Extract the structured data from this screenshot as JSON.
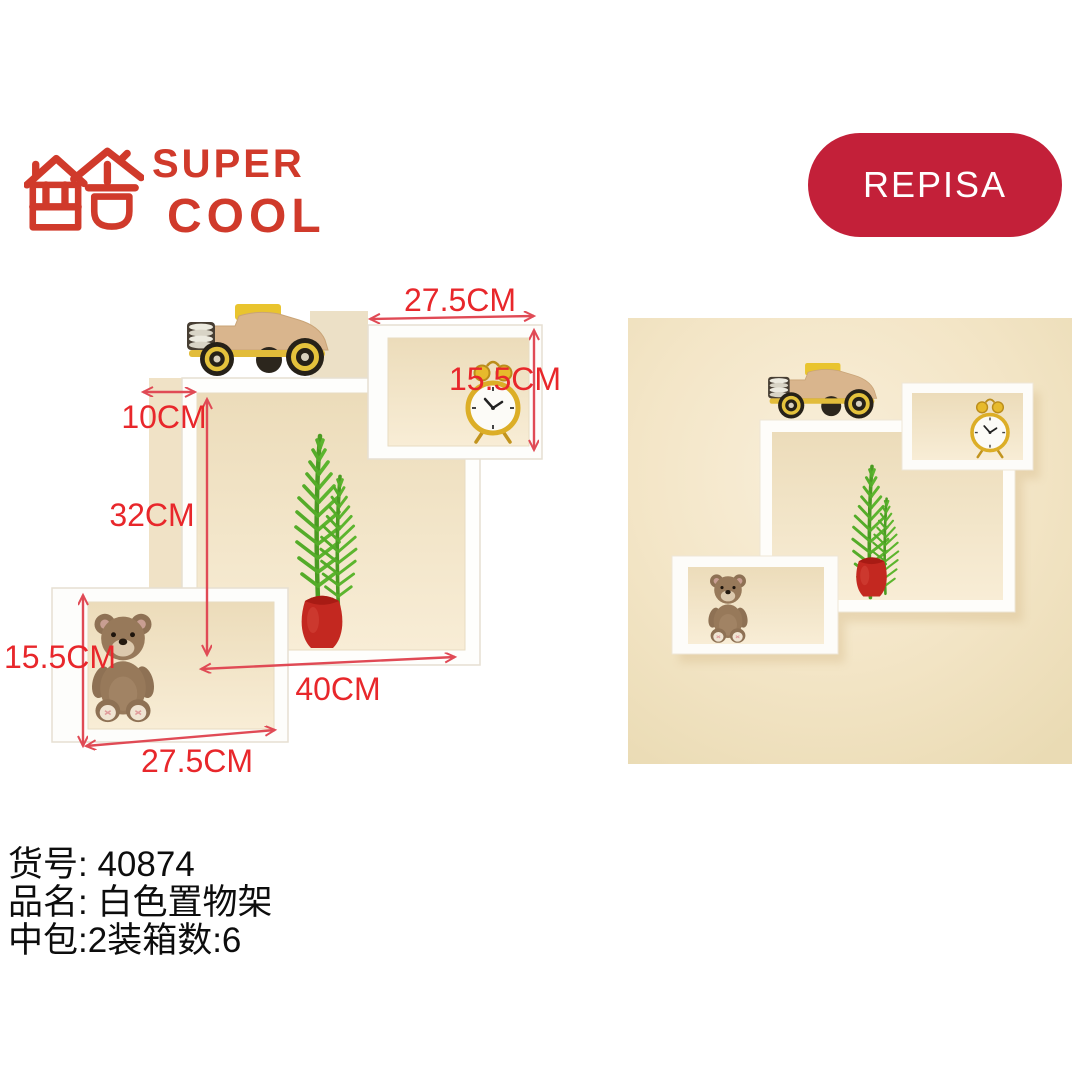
{
  "page": {
    "background_color": "#ffffff"
  },
  "brand": {
    "name_line1": "SUPER",
    "name_line2": "COOL",
    "logo_color": "#d03a2b",
    "logo_symbol": "house-shaped Chinese character (cool) mark"
  },
  "badge": {
    "label": "REPISA",
    "background_color": "#c32039",
    "text_color": "#ffffff"
  },
  "dimension_diagram": {
    "annotation_color": "#e8272b",
    "arrow_color": "#e04a55",
    "shelf_color": "#fdfdfb",
    "interior_color": "#f2e4c6",
    "labels": {
      "top_width": "27.5CM",
      "top_right_height": "15.5CM",
      "depth": "10CM",
      "main_height": "32CM",
      "main_width": "40CM",
      "left_box_height": "15.5CM",
      "bottom_width": "27.5CM"
    },
    "decorations": [
      "toy-car",
      "alarm-clock",
      "fern-plant",
      "red-vase",
      "teddy-bear"
    ]
  },
  "lifestyle_photo": {
    "wall_color": "#f3e5c6",
    "shelf_color": "#fdfcf9",
    "vase_color": "#c32820",
    "plant_color": "#5cb52e",
    "decorations": [
      "toy-car",
      "alarm-clock",
      "fern-plant",
      "red-vase",
      "teddy-bear"
    ]
  },
  "product_info": {
    "item_number_line": "货号: 40874",
    "name_line": "品名: 白色置物架",
    "packing_line": "中包:2装箱数:6"
  }
}
